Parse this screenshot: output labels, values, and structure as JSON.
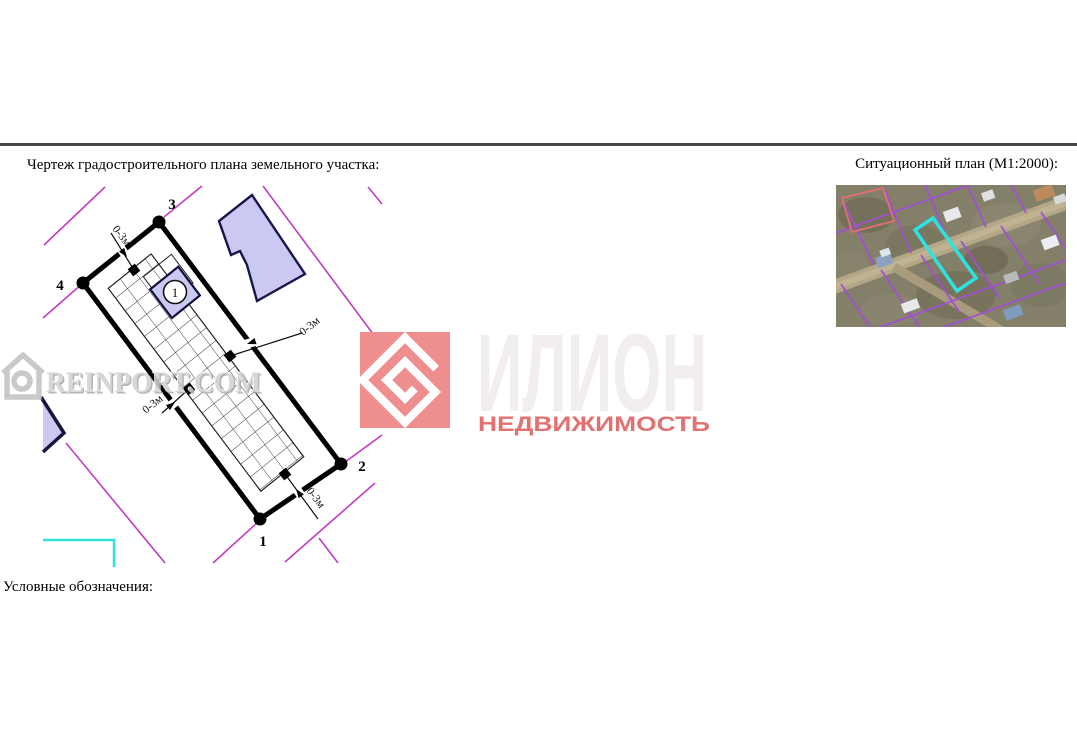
{
  "page": {
    "title_left": "Чертеж градостроительного плана земельного участка:",
    "title_right": "Ситуационный план (М1:2000):",
    "legend_label": "Условные обозначения:"
  },
  "plan": {
    "dim_label": "0-3м",
    "corner_labels": [
      "1",
      "2",
      "3",
      "4"
    ],
    "building_label": "1",
    "colors": {
      "boundary": "#000000",
      "parcel_line_magenta": "#c23cc2",
      "building_fill_lavender": "#c9c9f1",
      "building_stroke": "#16164a",
      "cyan_line": "#2ee2e2"
    }
  },
  "watermarks": {
    "reinport": {
      "text": "REINPORT.COM",
      "color": "#c9c9c9"
    },
    "ilion": {
      "name": "ИЛИОН",
      "subtitle": "НЕДВИЖИМОСТЬ",
      "square_color": "#ee8e8e",
      "name_color": "#f3eeee",
      "subtitle_color": "#e27272"
    }
  },
  "situational": {
    "highlight_color": "#2ee2e2",
    "parcel_line_color": "#a050d2",
    "red_parcel_color": "#e2706e"
  }
}
